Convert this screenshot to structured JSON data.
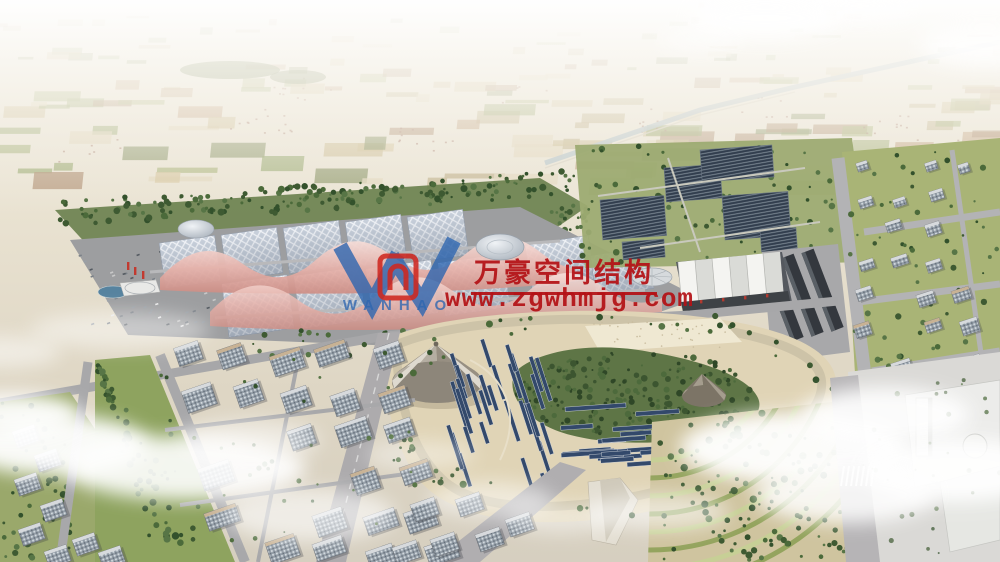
{
  "watermark": {
    "logo": {
      "letter": "W",
      "caption": "WANHAO"
    },
    "brand_text": "万豪空间结构",
    "url_text": "www.zgwhmjg.com",
    "colors": {
      "text_red": "#b41216",
      "logo_blue": "#2e66b0",
      "logo_red": "#cf2820"
    }
  }
}
